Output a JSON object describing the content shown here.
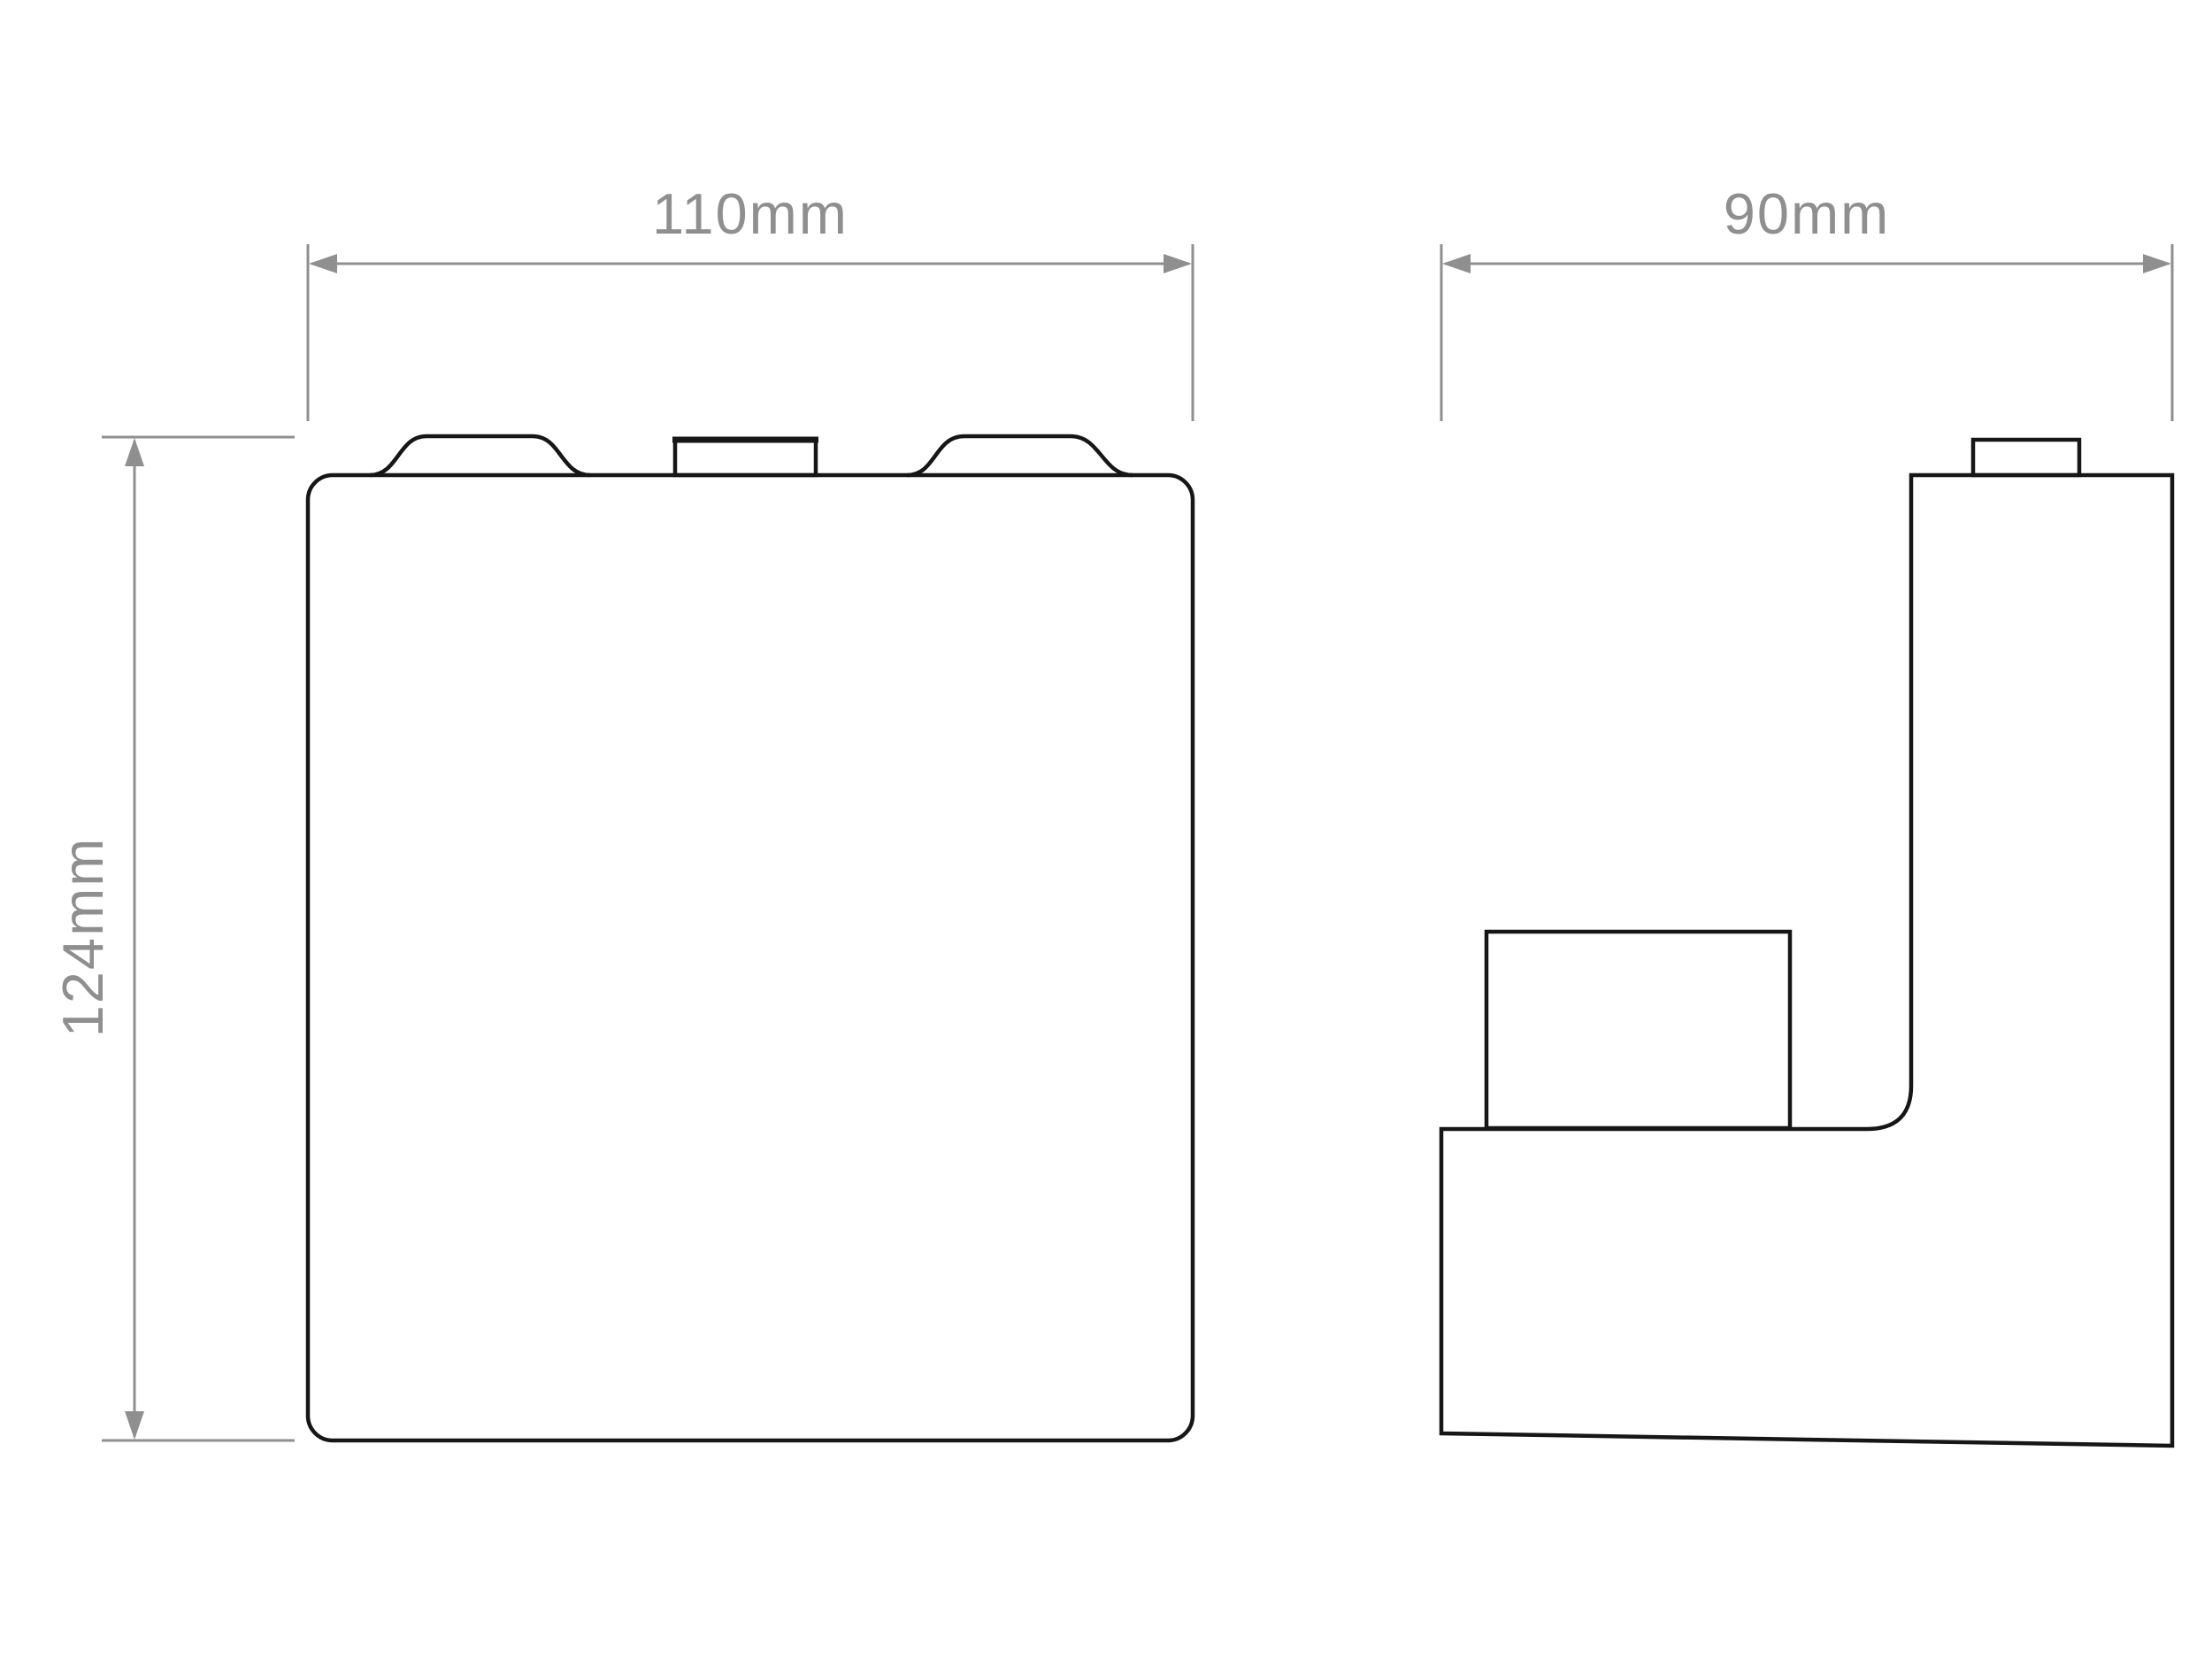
{
  "drawing": {
    "background": "#ffffff",
    "outline_color": "#161616",
    "dimension_color": "#8f8f8f",
    "labels": {
      "front_width": "110mm",
      "front_height": "124mm",
      "side_depth": "90mm"
    }
  }
}
